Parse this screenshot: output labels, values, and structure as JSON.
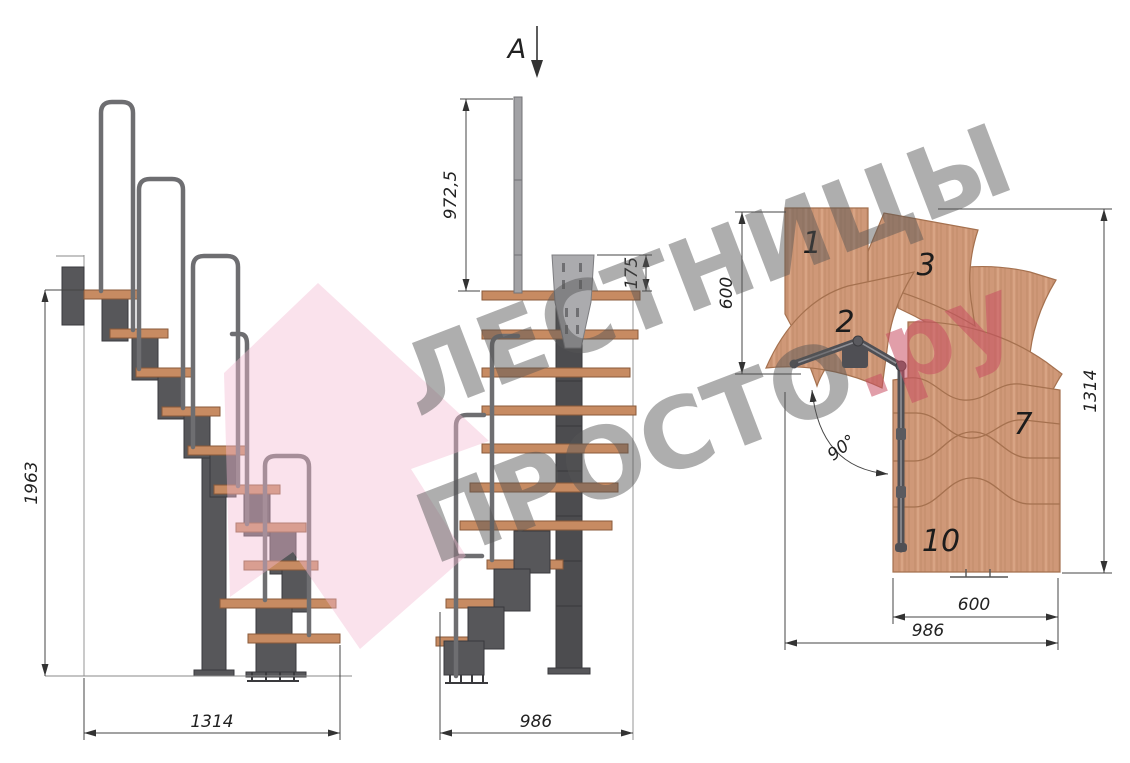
{
  "section_marker": {
    "label": "A"
  },
  "side_view": {
    "height_dim": "1963",
    "width_dim": "1314"
  },
  "front_view": {
    "rail_height_dim": "972,5",
    "plate_height_dim": "175",
    "width_dim": "986"
  },
  "plan_view": {
    "entry_depth_dim": "600",
    "length_dim": "1314",
    "run_width_dim": "600",
    "total_width_dim": "986",
    "angle_dim": "90°",
    "step_numbers": [
      "1",
      "2",
      "3",
      "7",
      "10"
    ]
  },
  "watermark": {
    "line1": "ЛЕСТНИЦЫ",
    "line2": "ПРОСТО",
    "line2_suffix": ".ру"
  },
  "colors": {
    "wood": "#cf9878",
    "tread": "#c78b62",
    "metal": "#55555a",
    "rail": "#6e6e71",
    "steel_pole": "#a2a2a5",
    "dim_line": "#444444",
    "watermark_gray": "#555555",
    "watermark_red": "#c94f63",
    "watermark_pink": "#f2b9d2"
  }
}
